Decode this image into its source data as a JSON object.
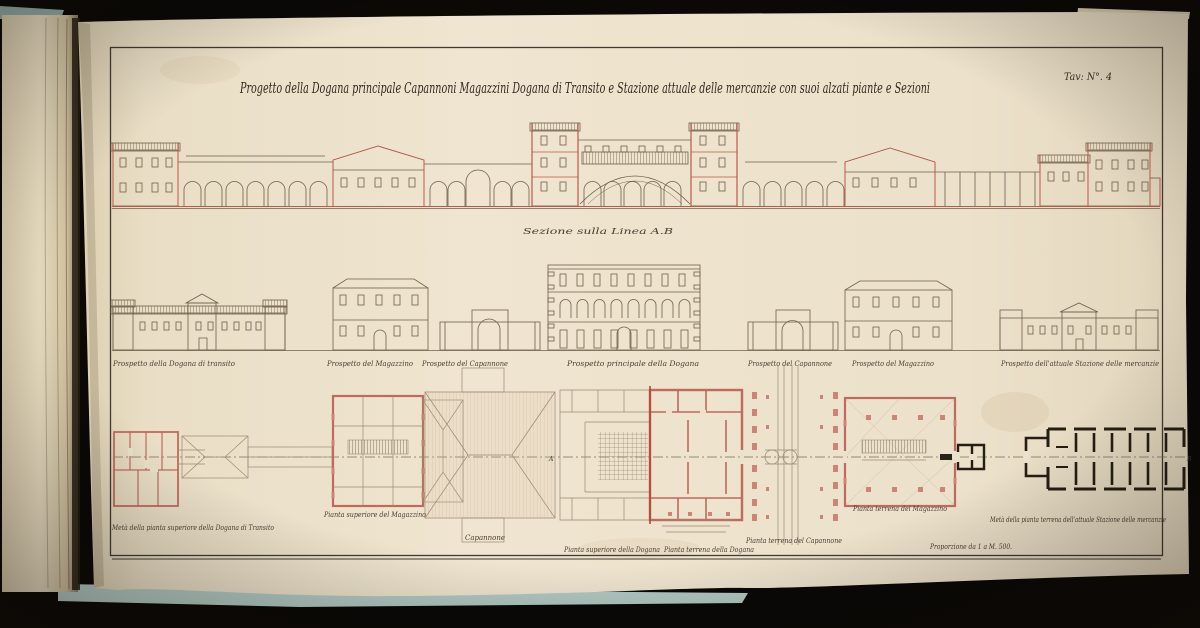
{
  "photo": {
    "background_color": "#0b0806",
    "book_cover_color": "#a9c0ba",
    "sheet_color": "#ece1ca",
    "ink_color": "#6e604c",
    "accent_red": "#c0564b",
    "plan_black": "#261e14"
  },
  "drawing": {
    "plate_number": "Tav: N°. 4",
    "title": "Progetto della Dogana principale Capannoni Magazzini Dogana di Transito e Stazione attuale delle mercanzie con suoi alzati piante e Sezioni",
    "section_caption": "Sezione sulla Linea A.B",
    "markers": [
      "A",
      "B"
    ],
    "elevation_labels": [
      "Prospetto della Dogana di transito",
      "Prospetto del Magazzino",
      "Prospetto del Capannone",
      "Prospetto principale della Dogana",
      "Prospetto del Capannone",
      "Prospetto del Magazzino",
      "Prospetto dell'attuale Stazione delle mercanzie"
    ],
    "plan_labels": [
      "Metà della pianta superiore della Dogana di Transito",
      "Pianta superiore del Magazzino",
      "Capannone",
      "Pianta superiore della Dogana",
      "Pianta terrena della Dogana",
      "Pianta terrena del Capannone",
      "Pianta terrena del Magazzino",
      "Metà della pianta terrena dell'attuale Stazione delle mercanzie"
    ],
    "scale_note": "Proporzione da 1 a M. 500."
  }
}
